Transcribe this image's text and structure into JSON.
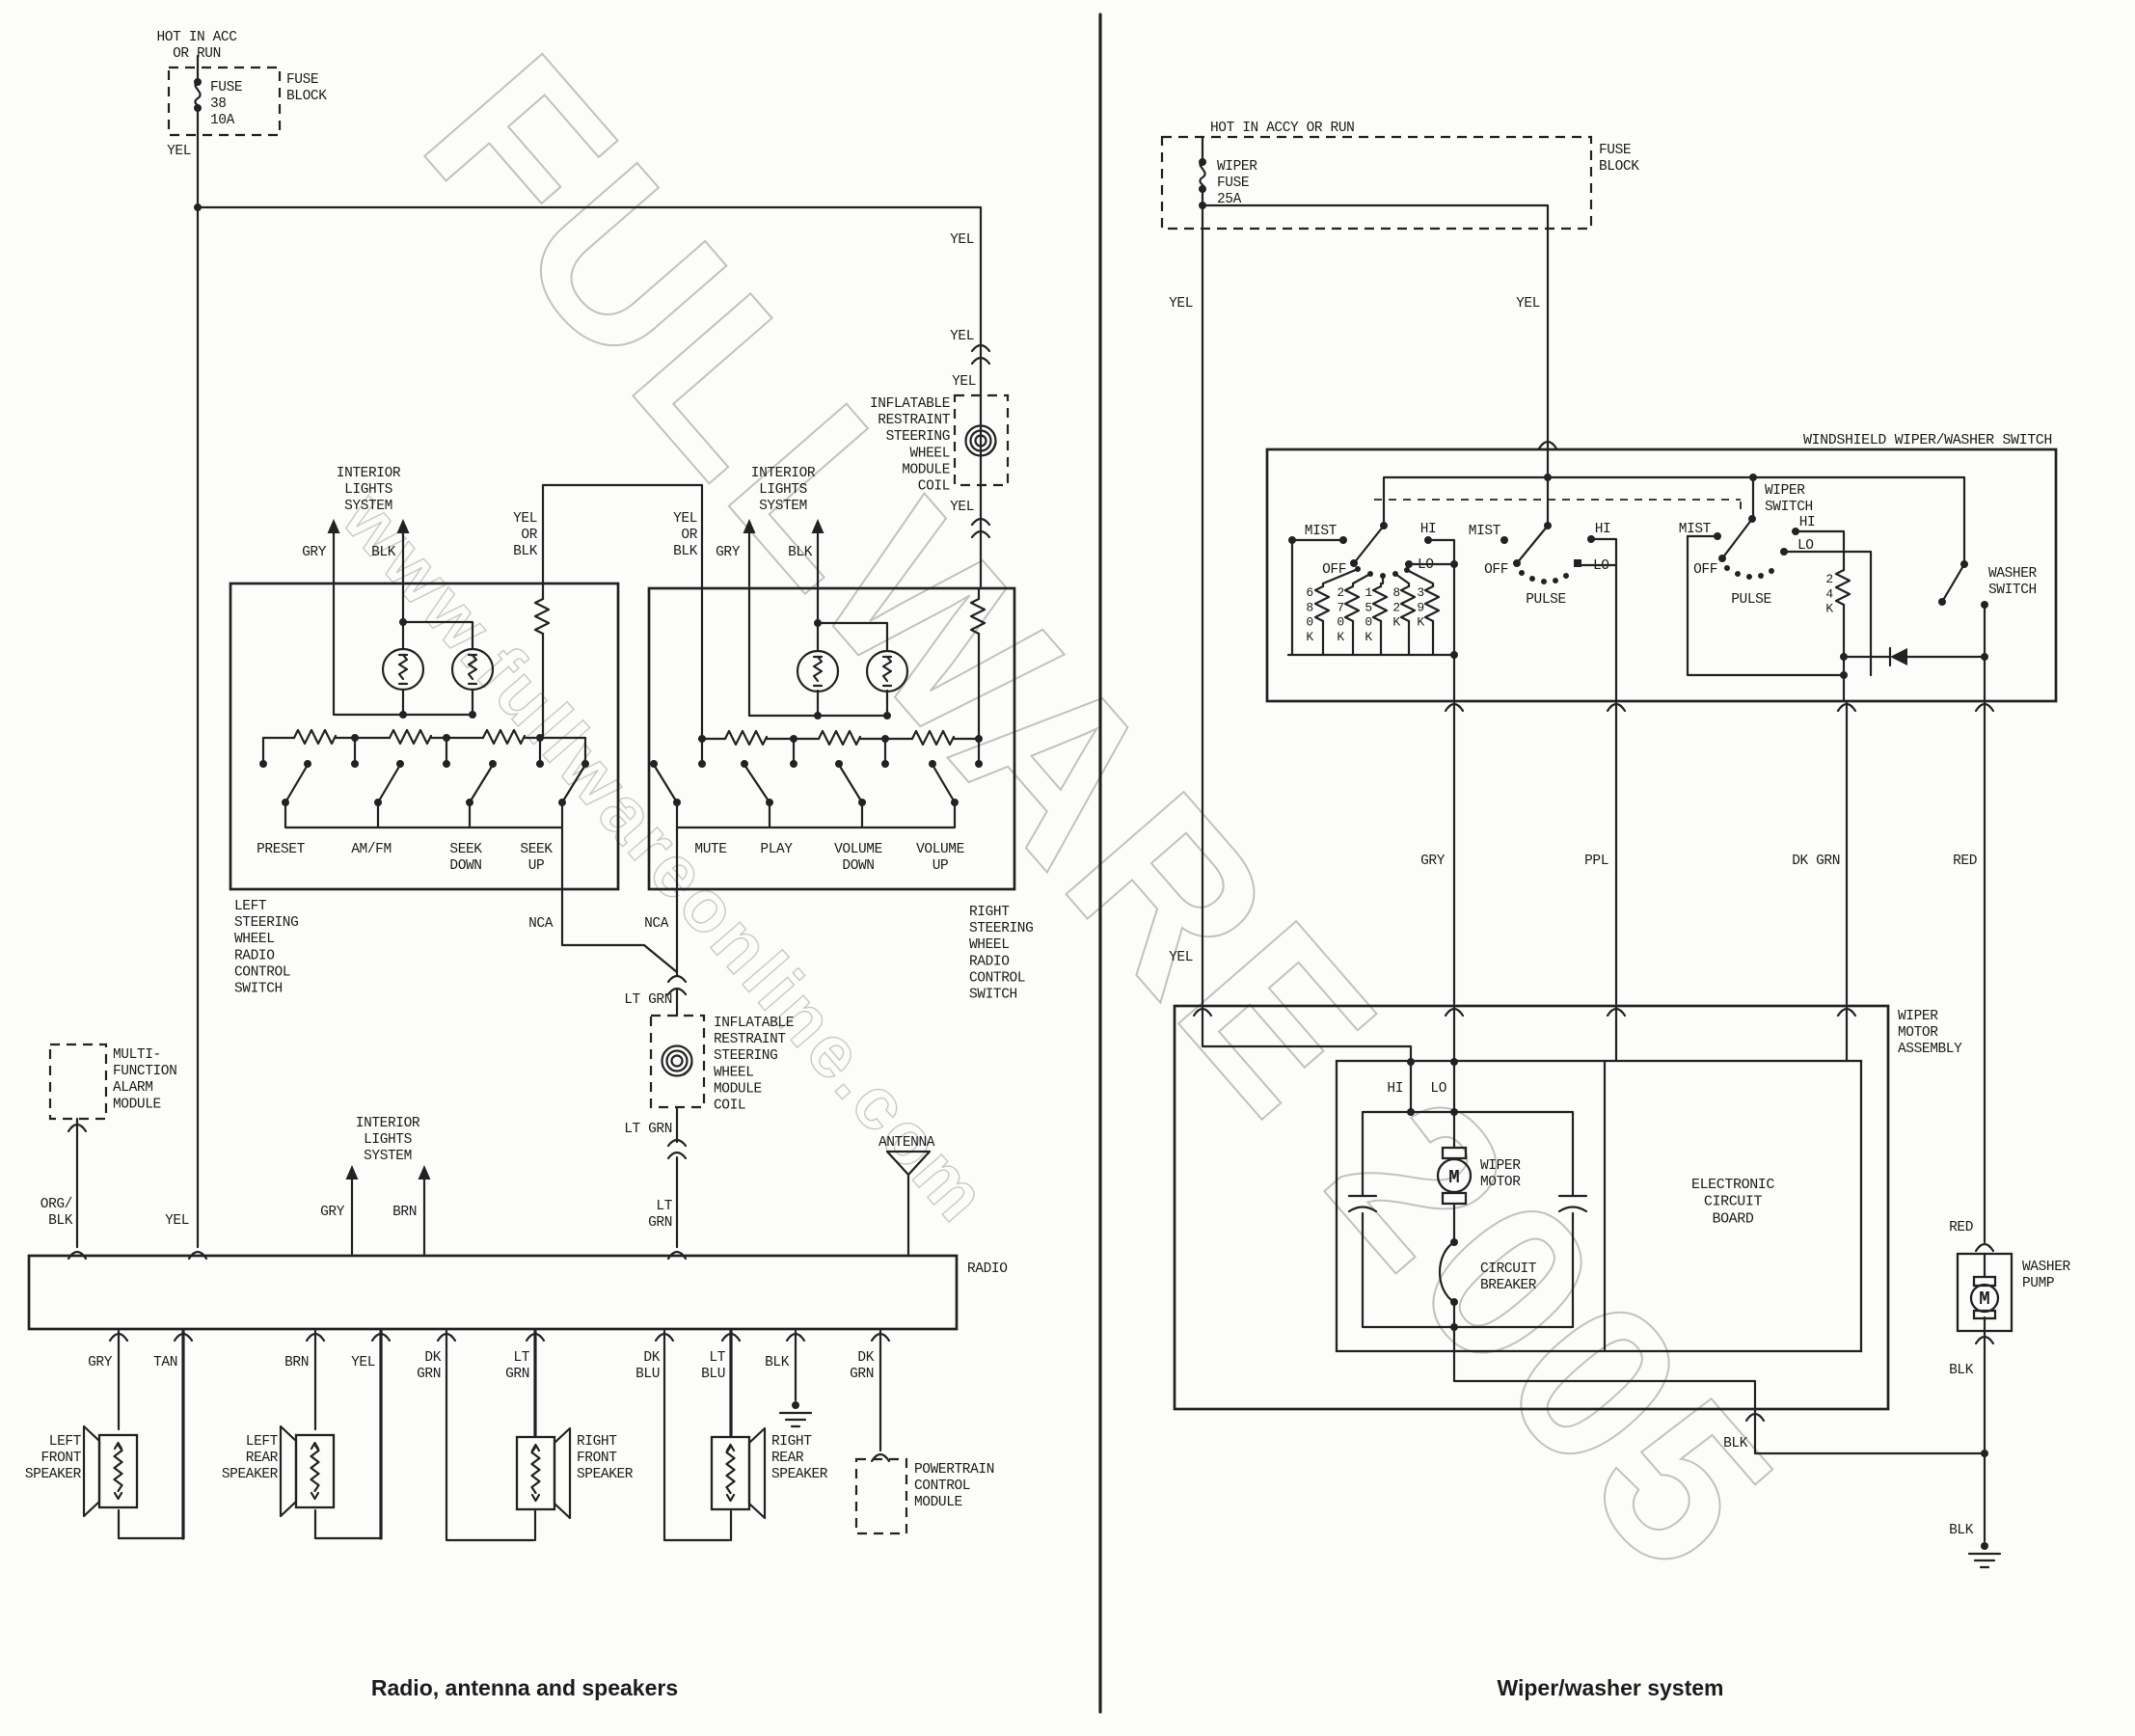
{
  "captions": {
    "left": "Radio, antenna and speakers",
    "right": "Wiper/washer system"
  },
  "watermark": {
    "name": "FULLWARE 2005",
    "url": "www.fullwareonline.com"
  },
  "colors": {
    "ink": "#222222",
    "paper": "#fcfcfa",
    "watermark": "#b7b7b5"
  },
  "l": {
    "hot": "HOT IN ACC\nOR RUN",
    "fuse": "FUSE\n38\n10A",
    "fuse_block": "FUSE\nBLOCK",
    "yel": "YEL",
    "il1": "INTERIOR\nLIGHTS\nSYSTEM",
    "il1_gry": "GRY",
    "il1_blk": "BLK",
    "yob_l": "YEL\nOR\nBLK",
    "yob_r": "YEL\nOR\nBLK",
    "il2": "INTERIOR\nLIGHTS\nSYSTEM",
    "il2_gry": "GRY",
    "il2_blk": "BLK",
    "yel1": "YEL",
    "yel2": "YEL",
    "yel3": "YEL",
    "yel4": "YEL",
    "coil1": "INFLATABLE\nRESTRAINT\nSTEERING\nWHEEL\nMODULE\nCOIL",
    "left_switch": "LEFT\nSTEERING\nWHEEL\nRADIO\nCONTROL\nSWITCH",
    "preset": "PRESET",
    "amfm": "AM/FM",
    "seek_down": "SEEK\nDOWN",
    "seek_up": "SEEK\nUP",
    "nca1": "NCA",
    "nca2": "NCA",
    "right_switch": "RIGHT\nSTEERING\nWHEEL\nRADIO\nCONTROL\nSWITCH",
    "mute": "MUTE",
    "play": "PLAY",
    "vol_down": "VOLUME\nDOWN",
    "vol_up": "VOLUME\nUP",
    "ltgrn1": "LT GRN",
    "coil2": "INFLATABLE\nRESTRAINT\nSTEERING\nWHEEL\nMODULE\nCOIL",
    "ltgrn2": "LT GRN",
    "ltgrn3": "LT\nGRN",
    "alarm": "MULTI-\nFUNCTION\nALARM\nMODULE",
    "orgblk": "ORG/\nBLK",
    "yel_radio": "YEL",
    "il3": "INTERIOR\nLIGHTS\nSYSTEM",
    "il3_gry": "GRY",
    "il3_brn": "BRN",
    "antenna": "ANTENNA",
    "radio": "RADIO",
    "w_gry": "GRY",
    "w_tan": "TAN",
    "w_brn": "BRN",
    "w_yel": "YEL",
    "w_dkgrn": "DK\nGRN",
    "w_ltgrn": "LT\nGRN",
    "w_dkblu": "DK\nBLU",
    "w_ltblu": "LT\nBLU",
    "w_blk": "BLK",
    "w_dkgrn2": "DK\nGRN",
    "spk1": "LEFT\nFRONT\nSPEAKER",
    "spk2": "LEFT\nREAR\nSPEAKER",
    "spk3": "RIGHT\nFRONT\nSPEAKER",
    "spk4": "RIGHT\nREAR\nSPEAKER",
    "pcm": "POWERTRAIN\nCONTROL\nMODULE"
  },
  "r": {
    "hot": "HOT IN ACCY OR RUN",
    "fuse": "WIPER\nFUSE\n25A",
    "fuse_block": "FUSE\nBLOCK",
    "yel1": "YEL",
    "yel2": "YEL",
    "yel3": "YEL",
    "title": "WINDSHIELD WIPER/WASHER SWITCH",
    "s1": {
      "mist": "MIST",
      "off": "OFF",
      "hi": "HI",
      "lo": "LO",
      "r1": "6\n8\n0\nK",
      "r2": "2\n7\n0\nK",
      "r3": "1\n5\n0\nK",
      "r4": "8\n2\nK",
      "r5": "3\n9\nK"
    },
    "s2": {
      "mist": "MIST",
      "off": "OFF",
      "hi": "HI",
      "lo": "LO",
      "pulse": "PULSE"
    },
    "s3": {
      "mist": "MIST",
      "off": "OFF",
      "hi": "HI",
      "lo": "LO",
      "pulse": "PULSE",
      "r": "2\n4\nK"
    },
    "wiper_switch": "WIPER\nSWITCH",
    "washer_switch": "WASHER\nSWITCH",
    "gry": "GRY",
    "ppl": "PPL",
    "dkgrn": "DK GRN",
    "red": "RED",
    "wma": "WIPER\nMOTOR\nASSEMBLY",
    "hi": "HI",
    "lo": "LO",
    "m": "M",
    "wiper_motor": "WIPER\nMOTOR",
    "breaker": "CIRCUIT\nBREAKER",
    "board": "ELECTRONIC\nCIRCUIT\nBOARD",
    "red2": "RED",
    "washer_pump": "WASHER\nPUMP",
    "m2": "M",
    "blk1": "BLK",
    "blk2": "BLK",
    "blk3": "BLK"
  }
}
